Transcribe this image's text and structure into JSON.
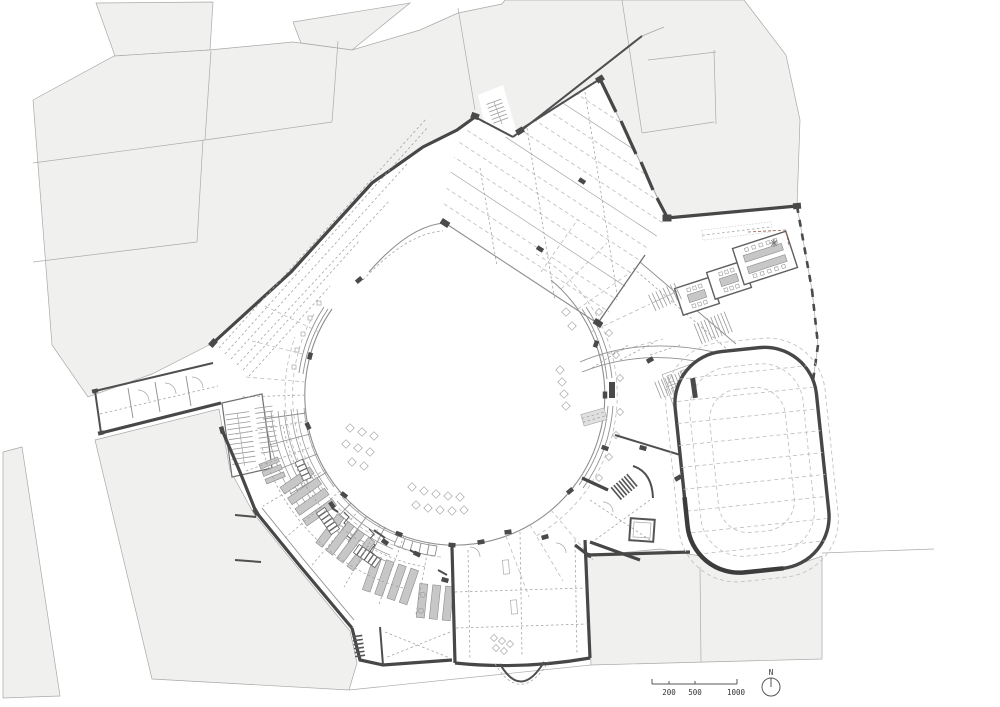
{
  "drawing": {
    "kind": "architectural ground floor plan",
    "features": [
      "context parcels",
      "central circular courtyard",
      "north hall",
      "classroom wing",
      "oval sports hall",
      "curved refectory wing",
      "west corridor arm",
      "south entrance hall"
    ]
  },
  "scale_bar": {
    "labels": [
      "200",
      "500",
      "1000"
    ]
  },
  "north_arrow": {
    "label": "N"
  },
  "colors": {
    "background": "#ffffff",
    "parcel_fill": "#f0f0ef",
    "parcel_stroke": "#a9a9a9",
    "wall_dark": "#474747",
    "line_medium": "#8f8f8f",
    "line_light": "#bcbcbc",
    "furniture_fill": "#c7c7c7",
    "accent_dashed_line": "#a0614f"
  }
}
